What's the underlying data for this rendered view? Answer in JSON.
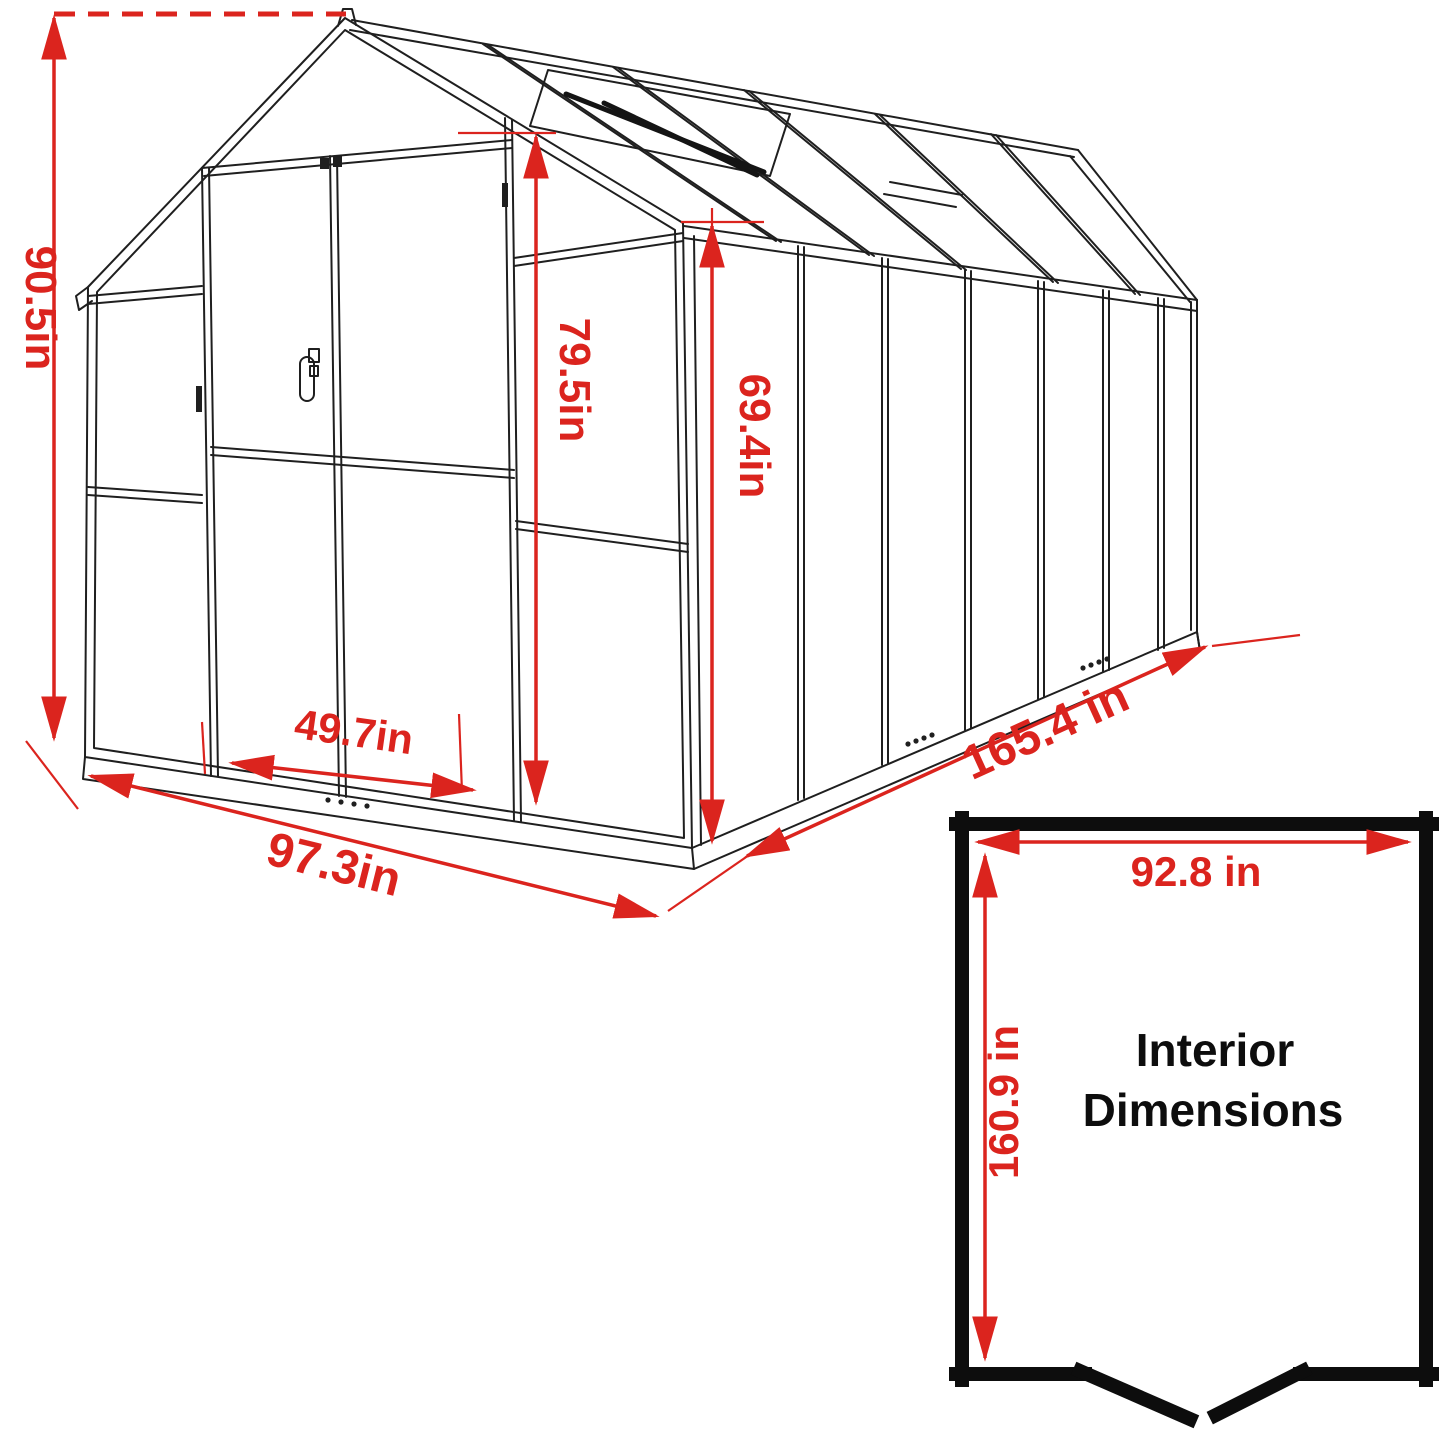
{
  "diagram": {
    "type": "greenhouse-dimension-drawing",
    "dimensions": {
      "overall_height": "90.5in",
      "door_height": "79.5in",
      "eave_height": "69.4in",
      "door_width": "49.7in",
      "front_width": "97.3in",
      "side_length": "165.4 in"
    },
    "interior_box": {
      "width": "92.8 in",
      "depth": "160.9 in",
      "title_line1": "Interior",
      "title_line2": "Dimensions"
    },
    "colors": {
      "dimension_red": "#DB241E",
      "line_black": "#1F1F1F"
    }
  }
}
